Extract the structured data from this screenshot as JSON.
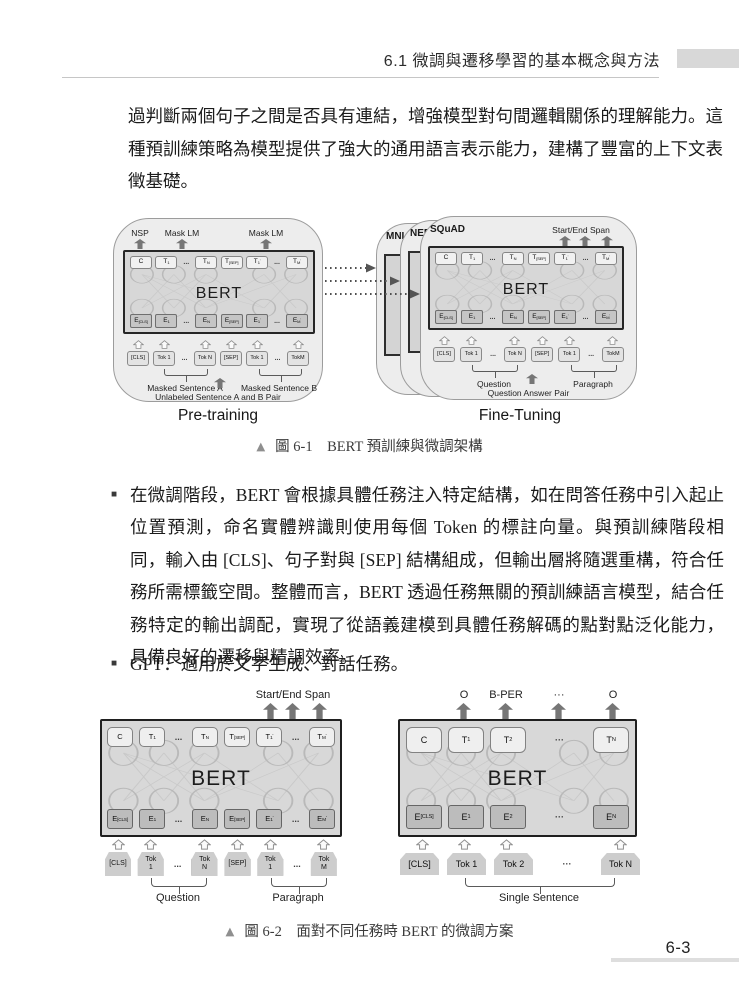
{
  "header": {
    "section": "6.1  微調與遷移學習的基本概念與方法"
  },
  "intro": "過判斷兩個句子之間是否具有連結，增強模型對句間邏輯關係的理解能力。這種預訓練策略為模型提供了強大的通用語言表示能力，建構了豐富的上下文表徵基礎。",
  "figure1": {
    "caption_marker": "▲",
    "caption": "圖 6-1　BERT 預訓練與微調架構",
    "pretraining": {
      "title": "Pre-training",
      "output_labels": [
        "NSP",
        "Mask LM",
        "Mask LM"
      ],
      "bert_label": "BERT",
      "t_row": [
        {
          "m": "C"
        },
        {
          "m": "T",
          "s": "1"
        },
        {
          "t": "dots",
          "m": "..."
        },
        {
          "m": "T",
          "s": "N"
        },
        {
          "m": "T",
          "s": "[SEP]"
        },
        {
          "m": "T",
          "s": "1",
          "p": "'"
        },
        {
          "t": "dots",
          "m": "..."
        },
        {
          "m": "T",
          "s": "M",
          "p": "'"
        }
      ],
      "e_row": [
        {
          "m": "E",
          "s": "[CLS]"
        },
        {
          "m": "E",
          "s": "1"
        },
        {
          "t": "dots",
          "m": "..."
        },
        {
          "m": "E",
          "s": "N"
        },
        {
          "m": "E",
          "s": "[SEP]"
        },
        {
          "m": "E",
          "s": "1",
          "p": "'"
        },
        {
          "t": "dots",
          "m": "..."
        },
        {
          "m": "E",
          "s": "M",
          "p": "'"
        }
      ],
      "input_row": [
        {
          "m": "[CLS]"
        },
        {
          "m": "Tok 1"
        },
        {
          "t": "dots",
          "m": "..."
        },
        {
          "m": "Tok N"
        },
        {
          "m": "[SEP]"
        },
        {
          "m": "Tok 1"
        },
        {
          "t": "dots",
          "m": "..."
        },
        {
          "m": "TokM"
        }
      ],
      "group_a": "Masked Sentence A",
      "group_b": "Masked Sentence B",
      "bottom_label": "Unlabeled Sentence A and B Pair"
    },
    "finetuning": {
      "title": "Fine-Tuning",
      "cards": [
        "MNLI",
        "NER",
        "SQuAD"
      ],
      "output_label": "Start/End Span",
      "bert_label": "BERT",
      "t_row": [
        {
          "m": "C"
        },
        {
          "m": "T",
          "s": "1"
        },
        {
          "t": "dots",
          "m": "..."
        },
        {
          "m": "T",
          "s": "N"
        },
        {
          "m": "T",
          "s": "[SEP]"
        },
        {
          "m": "T",
          "s": "1",
          "p": "'"
        },
        {
          "t": "dots",
          "m": "..."
        },
        {
          "m": "T",
          "s": "M",
          "p": "'"
        }
      ],
      "e_row": [
        {
          "m": "E",
          "s": "[CLS]"
        },
        {
          "m": "E",
          "s": "1"
        },
        {
          "t": "dots",
          "m": "..."
        },
        {
          "m": "E",
          "s": "N"
        },
        {
          "m": "E",
          "s": "[SEP]"
        },
        {
          "m": "E",
          "s": "1",
          "p": "'"
        },
        {
          "t": "dots",
          "m": "..."
        },
        {
          "m": "E",
          "s": "M",
          "p": "'"
        }
      ],
      "input_row": [
        {
          "m": "[CLS]"
        },
        {
          "m": "Tok 1"
        },
        {
          "t": "dots",
          "m": "..."
        },
        {
          "m": "Tok N"
        },
        {
          "m": "[SEP]"
        },
        {
          "m": "Tok 1"
        },
        {
          "t": "dots",
          "m": "..."
        },
        {
          "m": "TokM"
        }
      ],
      "group_a": "Question",
      "group_b": "Paragraph",
      "bottom_label": "Question Answer Pair"
    }
  },
  "bullets": [
    {
      "marker": "■",
      "text": "在微調階段，BERT 會根據具體任務注入特定結構，如在問答任務中引入起止位置預測，命名實體辨識則使用每個 Token 的標註向量。與預訓練階段相同，輸入由 [CLS]、句子對與 [SEP] 結構組成，但輸出層將隨選重構，符合任務所需標籤空間。整體而言，BERT 透過任務無關的預訓練語言模型，結合任務特定的輸出調配，實現了從語義建模到具體任務解碼的點對點泛化能力，具備良好的遷移與精調效率。"
    },
    {
      "marker": "■",
      "text": "GPT：適用於文字生成、對話任務。"
    }
  ],
  "figure2": {
    "caption_marker": "▲",
    "caption": "圖 6-2　面對不同任務時 BERT 的微調方案",
    "qa": {
      "output_label": "Start/End Span",
      "bert_label": "BERT",
      "t_row": [
        {
          "m": "C"
        },
        {
          "m": "T",
          "s": "1"
        },
        {
          "t": "dots",
          "m": "..."
        },
        {
          "m": "T",
          "s": "N"
        },
        {
          "m": "T",
          "s": "[SEP]"
        },
        {
          "m": "T",
          "s": "1",
          "p": "'"
        },
        {
          "t": "dots",
          "m": "..."
        },
        {
          "m": "T",
          "s": "M",
          "p": "'"
        }
      ],
      "e_row": [
        {
          "m": "E",
          "s": "[CLS]"
        },
        {
          "m": "E",
          "s": "1"
        },
        {
          "t": "dots",
          "m": "..."
        },
        {
          "m": "E",
          "s": "N"
        },
        {
          "m": "E",
          "s": "[SEP]"
        },
        {
          "m": "E",
          "s": "1",
          "p": "'"
        },
        {
          "t": "dots",
          "m": "..."
        },
        {
          "m": "E",
          "s": "M",
          "p": "'"
        }
      ],
      "input_row": [
        {
          "m": "[CLS]"
        },
        {
          "m": "Tok",
          "l2": "1"
        },
        {
          "t": "dots",
          "m": "..."
        },
        {
          "m": "Tok",
          "l2": "N"
        },
        {
          "m": "[SEP]"
        },
        {
          "m": "Tok",
          "l2": "1"
        },
        {
          "t": "dots",
          "m": "..."
        },
        {
          "m": "Tok",
          "l2": "M"
        }
      ],
      "group_a": "Question",
      "group_b": "Paragraph"
    },
    "ner": {
      "output_labels": [
        "O",
        "B-PER",
        "···",
        "O"
      ],
      "bert_label": "BERT",
      "t_row": [
        {
          "m": "C"
        },
        {
          "m": "T",
          "s": "1"
        },
        {
          "m": "T",
          "s": "2"
        },
        {
          "t": "dots",
          "m": "···"
        },
        {
          "m": "T",
          "s": "N"
        }
      ],
      "e_row": [
        {
          "m": "E",
          "s": "[CLS]"
        },
        {
          "m": "E",
          "s": "1"
        },
        {
          "m": "E",
          "s": "2"
        },
        {
          "t": "dots",
          "m": "···"
        },
        {
          "m": "E",
          "s": "N"
        }
      ],
      "input_row": [
        {
          "m": "[CLS]"
        },
        {
          "m": "Tok 1"
        },
        {
          "m": "Tok 2"
        },
        {
          "t": "dots",
          "m": "···"
        },
        {
          "m": "Tok N"
        }
      ],
      "group": "Single Sentence"
    }
  },
  "footer": {
    "page_number": "6-3"
  }
}
